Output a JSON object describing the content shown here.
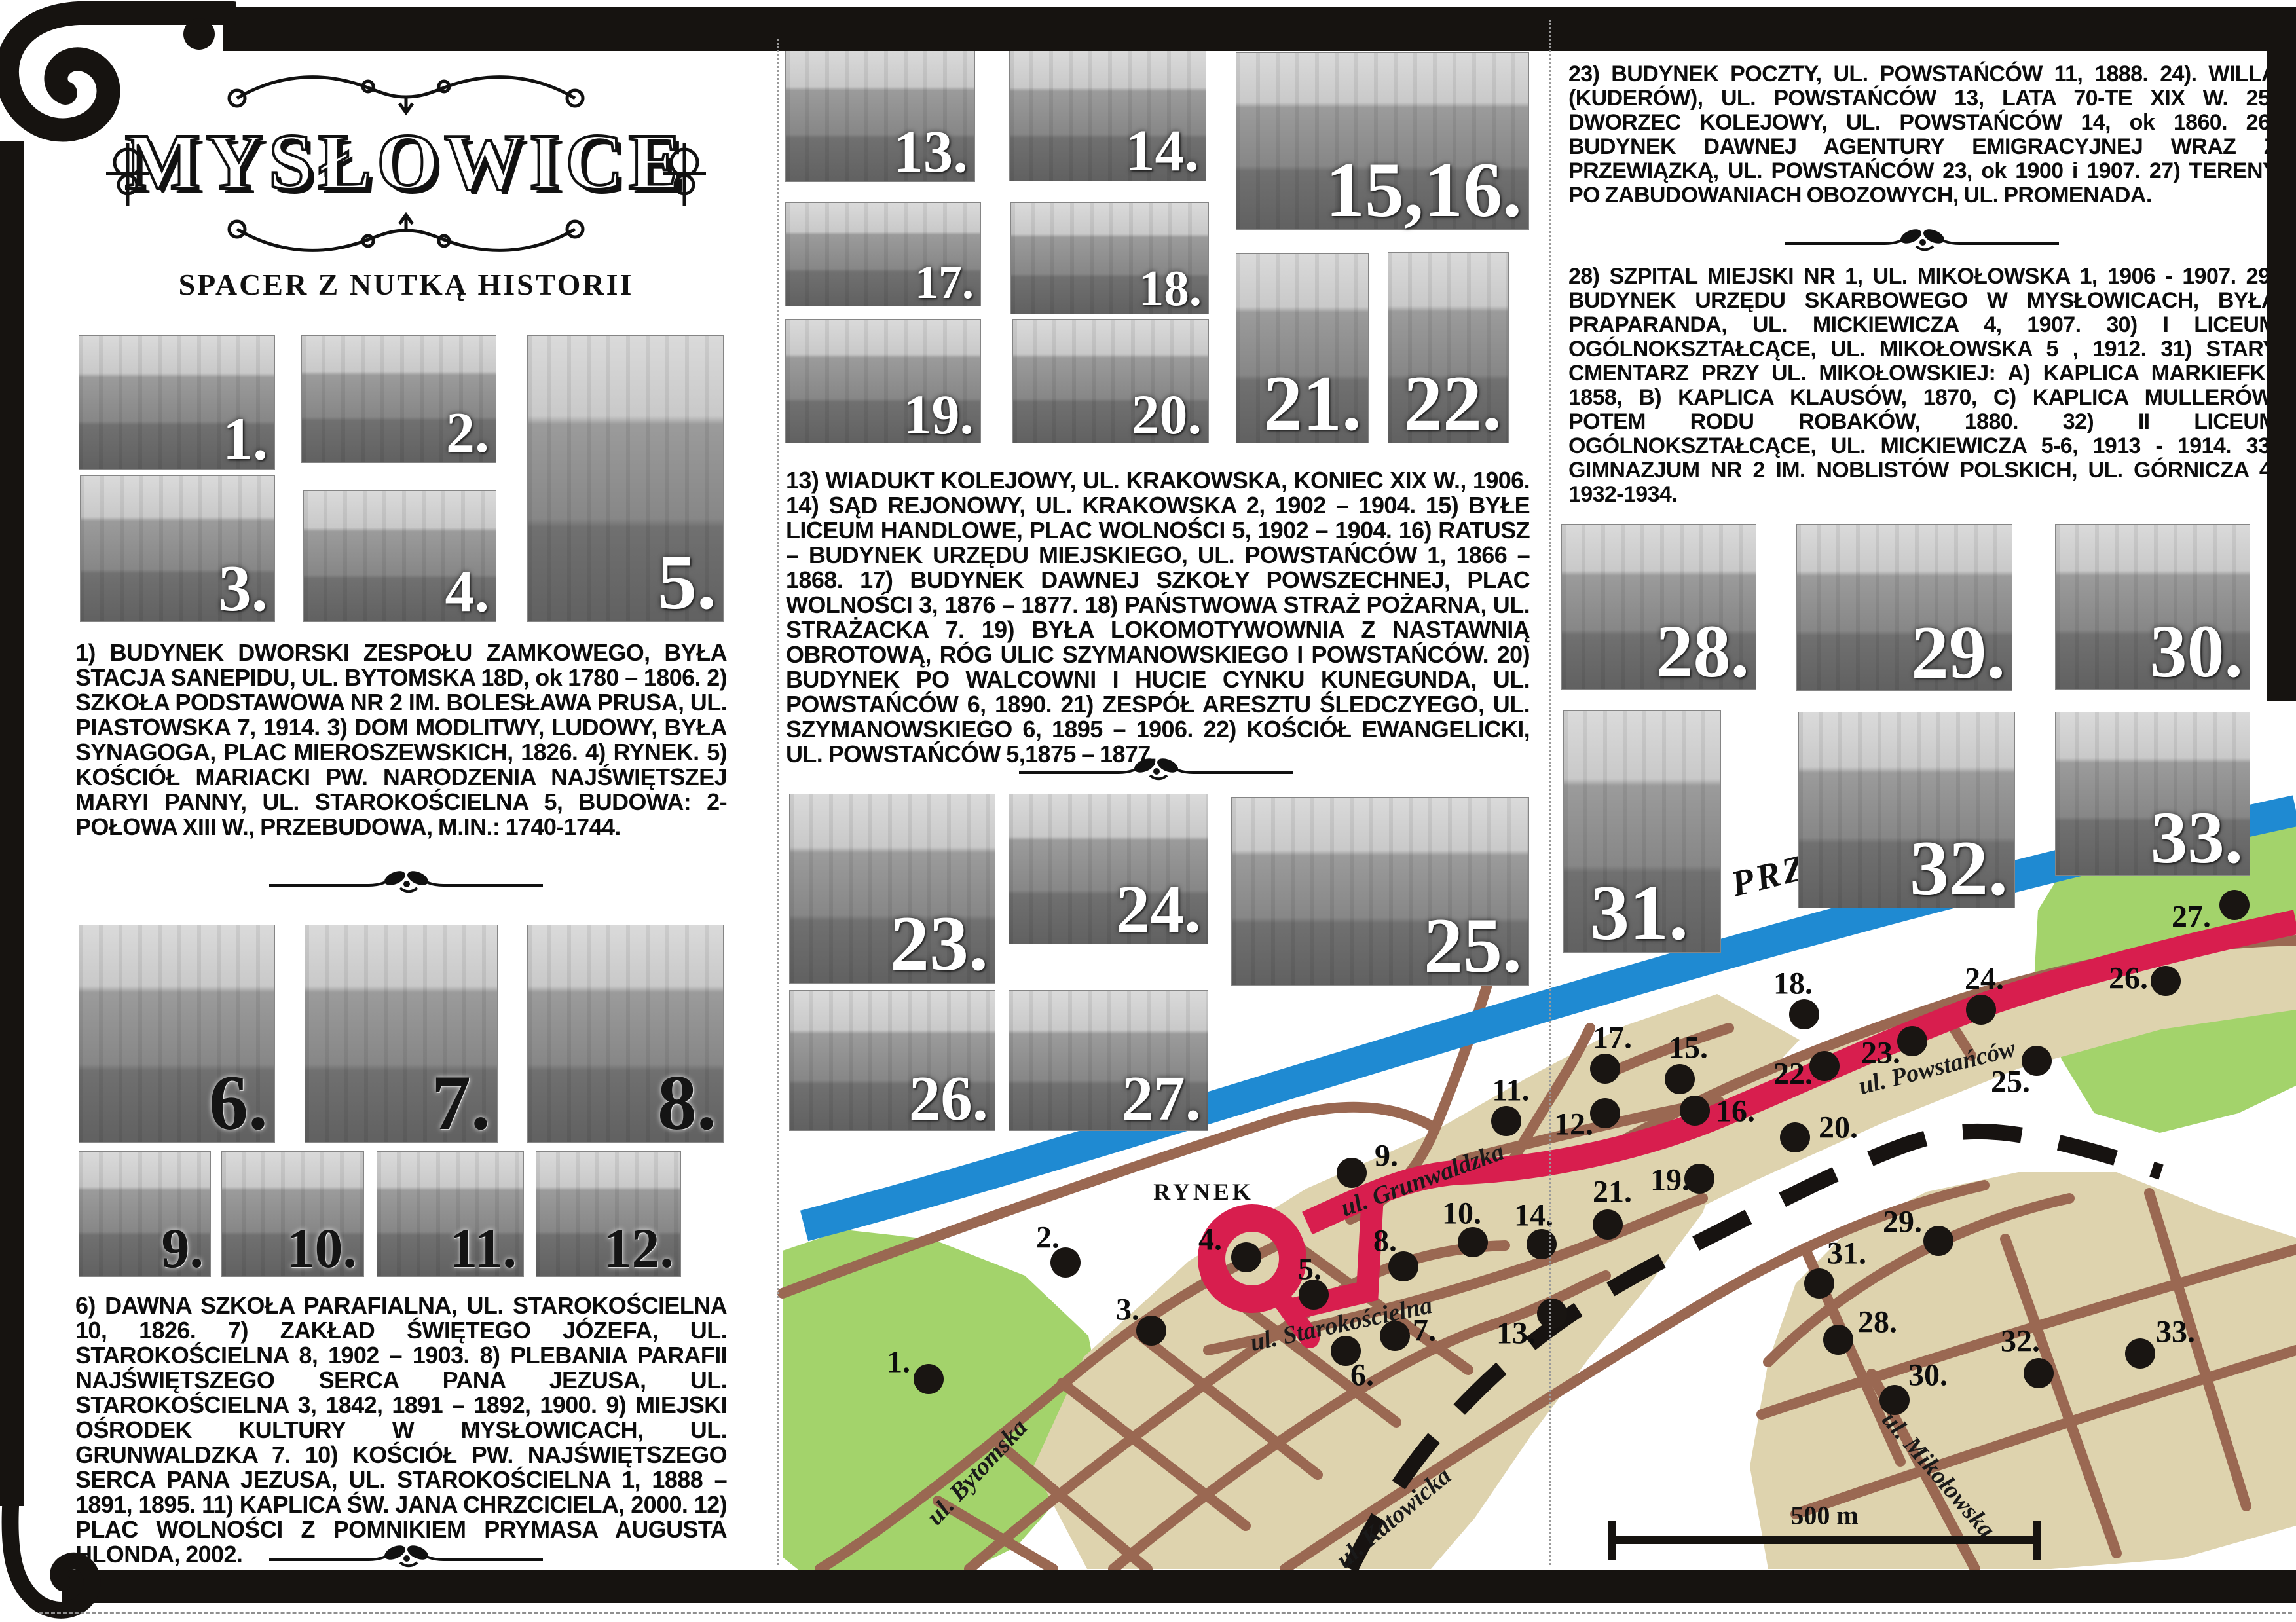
{
  "header": {
    "title": "MYSŁOWICE",
    "subtitle": "SPACER Z NUTKĄ HISTORII"
  },
  "blocks": {
    "b1_5": {
      "items": [
        {
          "n": "1)",
          "t": "BUDYNEK DWORSKI ZESPOŁU ZAMKOWEGO, BYŁA STACJA SANEPIDU, UL. BYTOMSKA 18D, ok 1780 – 1806."
        },
        {
          "n": "2)",
          "t": "SZKOŁA PODSTAWOWA NR 2 IM. BOLESŁAWA PRUSA, UL. PIASTOWSKA 7, 1914."
        },
        {
          "n": "3)",
          "t": "DOM MODLITWY, LUDOWY, BYŁA SYNAGOGA, PLAC MIEROSZEWSKICH, 1826."
        },
        {
          "n": "4)",
          "t": "RYNEK."
        },
        {
          "n": "5)",
          "t": "KOŚCIÓŁ MARIACKI PW. NARODZENIA NAJŚWIĘTSZEJ MARYI PANNY, UL. STAROKOŚCIELNA 5, BUDOWA: 2-POŁOWA XIII W., PRZEBUDOWA, M.IN.: 1740-1744."
        }
      ]
    },
    "b6_12": {
      "items": [
        {
          "n": "6)",
          "t": "DAWNA SZKOŁA PARAFIALNA, UL. STAROKOŚCIELNA 10, 1826."
        },
        {
          "n": "7)",
          "t": "ZAKŁAD ŚWIĘTEGO JÓZEFA, UL. STAROKOŚCIELNA 8, 1902 – 1903."
        },
        {
          "n": "8)",
          "t": "PLEBANIA PARAFII NAJŚWIĘTSZEGO SERCA PANA JEZUSA, UL. STAROKOŚCIELNA 3, 1842, 1891 – 1892, 1900."
        },
        {
          "n": "9)",
          "t": "MIEJSKI OŚRODEK KULTURY W MYSŁOWICACH, UL. GRUNWALDZKA 7."
        },
        {
          "n": "10)",
          "t": "KOŚCIÓŁ PW. NAJŚWIĘTSZEGO SERCA PANA JEZUSA, UL. STAROKOŚCIELNA 1, 1888 – 1891, 1895."
        },
        {
          "n": "11)",
          "t": "KAPLICA ŚW. JANA CHRZCICIELA, 2000."
        },
        {
          "n": "12)",
          "t": "PLAC WOLNOŚCI Z POMNIKIEM PRYMASA AUGUSTA HLONDA, 2002."
        }
      ]
    },
    "b13_22": {
      "items": [
        {
          "n": "13)",
          "t": "WIADUKT KOLEJOWY, UL. KRAKOWSKA, KONIEC XIX W., 1906."
        },
        {
          "n": "14)",
          "t": "SĄD REJONOWY, UL. KRAKOWSKA 2, 1902 – 1904."
        },
        {
          "n": "15)",
          "t": "BYŁE LICEUM HANDLOWE, PLAC WOLNOŚCI 5, 1902 – 1904."
        },
        {
          "n": "16)",
          "t": "RATUSZ – BUDYNEK URZĘDU MIEJSKIEGO, UL. POWSTAŃCÓW 1, 1866 – 1868."
        },
        {
          "n": "17)",
          "t": "BUDYNEK DAWNEJ SZKOŁY POWSZECHNEJ, PLAC WOLNOŚCI 3, 1876 – 1877."
        },
        {
          "n": "18)",
          "t": "PAŃSTWOWA STRAŻ POŻARNA, UL. STRAŻACKA 7."
        },
        {
          "n": "19)",
          "t": "BYŁA LOKOMOTYWOWNIA Z NASTAWNIĄ OBROTOWĄ, RÓG ULIC SZYMANOWSKIEGO I POWSTAŃCÓW."
        },
        {
          "n": "20)",
          "t": "BUDYNEK PO WALCOWNI I HUCIE CYNKU KUNEGUNDA, UL. POWSTAŃCÓW 6, 1890."
        },
        {
          "n": "21)",
          "t": "ZESPÓŁ ARESZTU ŚLEDCZYEGO, UL. SZYMANOWSKIEGO 6, 1895 – 1906."
        },
        {
          "n": "22)",
          "t": "KOŚCIÓŁ EWANGELICKI, UL. POWSTAŃCÓW 5,1875 – 1877."
        }
      ]
    },
    "b23_27": {
      "items": [
        {
          "n": "23)",
          "t": "BUDYNEK POCZTY, UL. POWSTAŃCÓW 11, 1888."
        },
        {
          "n": "24).",
          "t": "WILLA (KUDERÓW), UL. POWSTAŃCÓW 13, LATA 70-TE XIX W."
        },
        {
          "n": "25)",
          "t": "DWORZEC KOLEJOWY, UL. POWSTAŃCÓW 14, ok 1860."
        },
        {
          "n": "26)",
          "t": "BUDYNEK DAWNEJ AGENTURY EMIGRACYJNEJ WRAZ Z PRZEWIĄZKĄ, UL. POWSTAŃCÓW 23, ok 1900 i 1907."
        },
        {
          "n": "27)",
          "t": "TERENY PO ZABUDOWANIACH OBOZOWYCH, UL. PROMENADA."
        }
      ]
    },
    "b28_33": {
      "items": [
        {
          "n": "28)",
          "t": "SZPITAL MIEJSKI NR 1, UL. MIKOŁOWSKA 1, 1906 - 1907."
        },
        {
          "n": "29)",
          "t": "BUDYNEK URZĘDU SKARBOWEGO W MYSŁOWICACH, BYŁA PRAPARANDA, UL. MICKIEWICZA 4, 1907."
        },
        {
          "n": "30)",
          "t": "I LICEUM OGÓLNOKSZTAŁCĄCE, UL. MIKOŁOWSKA 5 , 1912."
        },
        {
          "n": "31)",
          "t": "STARY CMENTARZ PRZY UL. MIKOŁOWSKIEJ: A) KAPLICA MARKIEFKI, 1858, B) KAPLICA KLAUSÓW, 1870, C) KAPLICA MULLERÓW, POTEM RODU ROBAKÓW, 1880."
        },
        {
          "n": "32)",
          "t": "II LICEUM OGÓLNOKSZTAŁCĄCE, UL. MICKIEWICZA 5-6, 1913 - 1914."
        },
        {
          "n": "33)",
          "t": "GIMNAZJUM NR 2 IM. NOBLISTÓW POLSKICH, UL. GÓRNICZA 4, 1932-1934."
        }
      ]
    }
  },
  "photos": [
    {
      "id": "p1",
      "label": "1."
    },
    {
      "id": "p2",
      "label": "2."
    },
    {
      "id": "p3",
      "label": "3."
    },
    {
      "id": "p4",
      "label": "4."
    },
    {
      "id": "p5",
      "label": "5."
    },
    {
      "id": "p6",
      "label": "6."
    },
    {
      "id": "p7",
      "label": "7."
    },
    {
      "id": "p8",
      "label": "8."
    },
    {
      "id": "p9",
      "label": "9."
    },
    {
      "id": "p10",
      "label": "10."
    },
    {
      "id": "p11",
      "label": "11."
    },
    {
      "id": "p12",
      "label": "12."
    },
    {
      "id": "p13",
      "label": "13."
    },
    {
      "id": "p14",
      "label": "14."
    },
    {
      "id": "p15_16",
      "label": "15,16."
    },
    {
      "id": "p17",
      "label": "17."
    },
    {
      "id": "p18",
      "label": "18."
    },
    {
      "id": "p19",
      "label": "19."
    },
    {
      "id": "p20",
      "label": "20."
    },
    {
      "id": "p21",
      "label": "21."
    },
    {
      "id": "p22",
      "label": "22."
    },
    {
      "id": "p23",
      "label": "23."
    },
    {
      "id": "p24",
      "label": "24."
    },
    {
      "id": "p25",
      "label": "25."
    },
    {
      "id": "p26",
      "label": "26."
    },
    {
      "id": "p27",
      "label": "27."
    },
    {
      "id": "p28",
      "label": "28."
    },
    {
      "id": "p29",
      "label": "29."
    },
    {
      "id": "p30",
      "label": "30."
    },
    {
      "id": "p31",
      "label": "31."
    },
    {
      "id": "p32",
      "label": "32."
    },
    {
      "id": "p33",
      "label": "33."
    }
  ],
  "map": {
    "square": "RYNEK",
    "river": "PRZEMSZA",
    "scale": "500 m",
    "streets": {
      "bytomska": "ul. Bytomska",
      "katowicka": "ul. Katowicka",
      "starokoscielna": "ul. Starokościelna",
      "grunwaldzka": "ul. Grunwaldzka",
      "powstancow": "ul. Powstańców",
      "mikolowska": "ul. Mikołowska"
    },
    "colors": {
      "route": "#d81e4e",
      "river": "#1f8ad2",
      "street": "#9a6852",
      "park": "#a3d36b",
      "city": "#ded3ae"
    },
    "points": [
      {
        "label": "1.",
        "dot": [
          1418,
          2106
        ],
        "lab": [
          1372,
          2080
        ]
      },
      {
        "label": "2.",
        "dot": [
          1627,
          1928
        ],
        "lab": [
          1600,
          1890
        ]
      },
      {
        "label": "3.",
        "dot": [
          1758,
          2032
        ],
        "lab": [
          1722,
          2000
        ]
      },
      {
        "label": "4.",
        "dot": [
          1903,
          1920
        ],
        "lab": [
          1848,
          1893
        ]
      },
      {
        "label": "5.",
        "dot": [
          2006,
          1977
        ],
        "lab": [
          2000,
          1938
        ]
      },
      {
        "label": "6.",
        "dot": [
          2055,
          2063
        ],
        "lab": [
          2080,
          2100
        ]
      },
      {
        "label": "7.",
        "dot": [
          2130,
          2040
        ],
        "lab": [
          2175,
          2032
        ]
      },
      {
        "label": "8.",
        "dot": [
          2143,
          1934
        ],
        "lab": [
          2115,
          1895
        ]
      },
      {
        "label": "9.",
        "dot": [
          2064,
          1791
        ],
        "lab": [
          2117,
          1765
        ]
      },
      {
        "label": "10.",
        "dot": [
          2249,
          1897
        ],
        "lab": [
          2232,
          1853
        ]
      },
      {
        "label": "11.",
        "dot": [
          2300,
          1712
        ],
        "lab": [
          2307,
          1665
        ]
      },
      {
        "label": "12.",
        "dot": [
          2451,
          1700
        ],
        "lab": [
          2403,
          1717
        ]
      },
      {
        "label": "13.",
        "dot": [
          2370,
          2006
        ],
        "lab": [
          2315,
          2036
        ]
      },
      {
        "label": "14.",
        "dot": [
          2354,
          1900
        ],
        "lab": [
          2342,
          1856
        ]
      },
      {
        "label": "15.",
        "dot": [
          2565,
          1648
        ],
        "lab": [
          2578,
          1600
        ]
      },
      {
        "label": "16.",
        "dot": [
          2588,
          1696
        ],
        "lab": [
          2650,
          1697
        ]
      },
      {
        "label": "17.",
        "dot": [
          2451,
          1632
        ],
        "lab": [
          2462,
          1585
        ]
      },
      {
        "label": "18.",
        "dot": [
          2755,
          1549
        ],
        "lab": [
          2738,
          1502
        ]
      },
      {
        "label": "19.",
        "dot": [
          2595,
          1800
        ],
        "lab": [
          2550,
          1802
        ]
      },
      {
        "label": "20.",
        "dot": [
          2741,
          1737
        ],
        "lab": [
          2807,
          1722
        ]
      },
      {
        "label": "21.",
        "dot": [
          2455,
          1870
        ],
        "lab": [
          2462,
          1820
        ]
      },
      {
        "label": "22.",
        "dot": [
          2786,
          1628
        ],
        "lab": [
          2738,
          1640
        ]
      },
      {
        "label": "23.",
        "dot": [
          2920,
          1590
        ],
        "lab": [
          2872,
          1608
        ]
      },
      {
        "label": "24.",
        "dot": [
          3025,
          1542
        ],
        "lab": [
          3030,
          1495
        ]
      },
      {
        "label": "25.",
        "dot": [
          3110,
          1620
        ],
        "lab": [
          3070,
          1652
        ]
      },
      {
        "label": "26.",
        "dot": [
          3307,
          1498
        ],
        "lab": [
          3250,
          1494
        ]
      },
      {
        "label": "27.",
        "dot": [
          3412,
          1382
        ],
        "lab": [
          3346,
          1400
        ]
      },
      {
        "label": "28.",
        "dot": [
          2807,
          2046
        ],
        "lab": [
          2867,
          2019
        ]
      },
      {
        "label": "29.",
        "dot": [
          2960,
          1895
        ],
        "lab": [
          2905,
          1866
        ]
      },
      {
        "label": "30.",
        "dot": [
          2893,
          2138
        ],
        "lab": [
          2944,
          2100
        ]
      },
      {
        "label": "31.",
        "dot": [
          2778,
          1960
        ],
        "lab": [
          2820,
          1914
        ]
      },
      {
        "label": "32.",
        "dot": [
          3113,
          2097
        ],
        "lab": [
          3085,
          2048
        ]
      },
      {
        "label": "33.",
        "dot": [
          3268,
          2067
        ],
        "lab": [
          3322,
          2034
        ]
      }
    ]
  }
}
